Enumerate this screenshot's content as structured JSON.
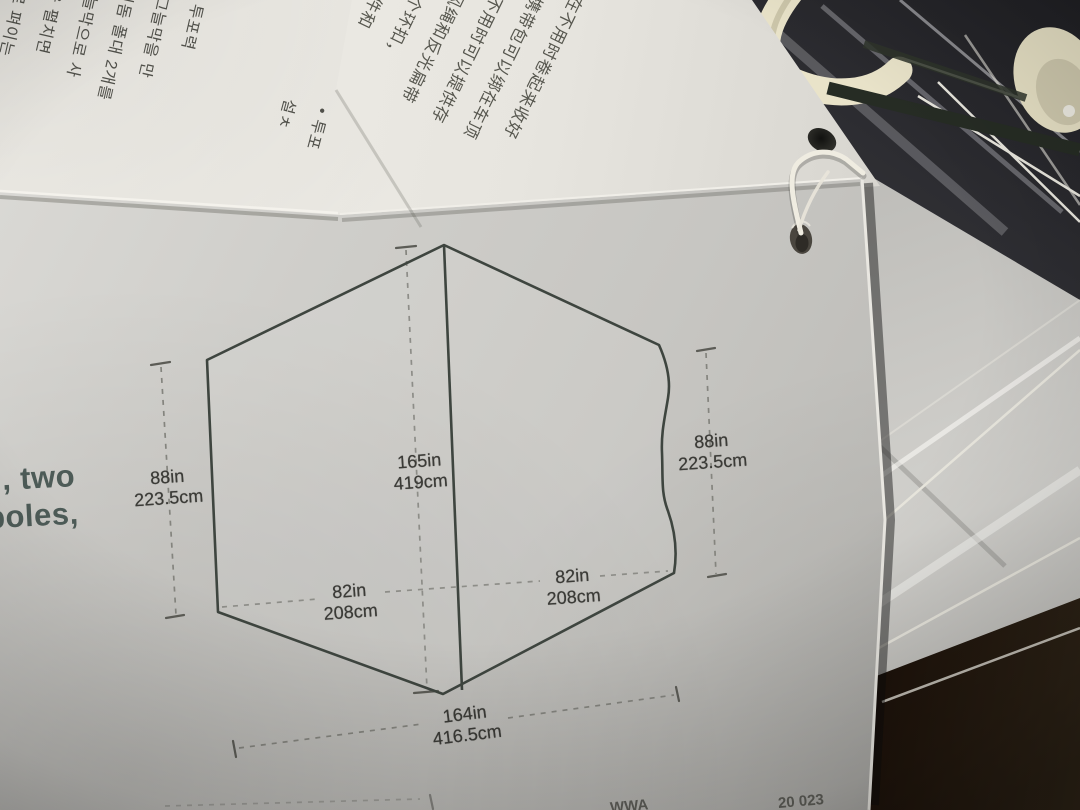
{
  "papers": {
    "korean": {
      "columns": [
        "동저 투포력",
        "에서 그늘막을 만",
        "일 투미돔 폴대 2개를",
        "틀한 그늘막으로 사",
        "천 패들을 펼치면",
        "바람막이로 펴이는",
        "과 함께 테브한"
      ],
      "edge_column_fragments": [
        "• 투포",
        "설ㅊ"
      ]
    },
    "chinese": {
      "columns": [
        "或在不用时卷起来收好",
        "建时携带包可以绑在车顶",
        "架上，不用时可以提供存",
        "• 反光防风绳和反光扁带",
        "帐篷内有多个环扣，",
        "工具顶棚、配件和",
        "镜和露营灯"
      ],
      "corner_fragments": [
        "出捷",
        "丝风"
      ]
    }
  },
  "page": {
    "margin_text": {
      "line1": ", two",
      "line2": "poles,"
    },
    "bottom_fragments": {
      "left": "WWA",
      "right": "20 023"
    },
    "diagram": {
      "type": "dimension-diagram",
      "subject": "tent footprint",
      "labels": {
        "left_height": {
          "in": "88in",
          "cm": "223.5cm"
        },
        "ridge": {
          "in": "165in",
          "cm": "419cm"
        },
        "right_height": {
          "in": "88in",
          "cm": "223.5cm"
        },
        "left_width": {
          "in": "82in",
          "cm": "208cm"
        },
        "right_width": {
          "in": "82in",
          "cm": "208cm"
        },
        "total_width": {
          "in": "164in",
          "cm": "416.5cm"
        }
      }
    }
  },
  "colors": {
    "page_gray": "#c9c8c4",
    "paper_white": "#edebe5",
    "diagram_line": "#3e453f",
    "dash_line": "#84847e",
    "label_text": "#3b3b37",
    "margin_text": "#4d5b57",
    "cjk_text": "#55554f",
    "hook_cream": "#e9e3c9",
    "floor_dark": "#21150d",
    "plastic_bag": "#b9b8b4"
  }
}
